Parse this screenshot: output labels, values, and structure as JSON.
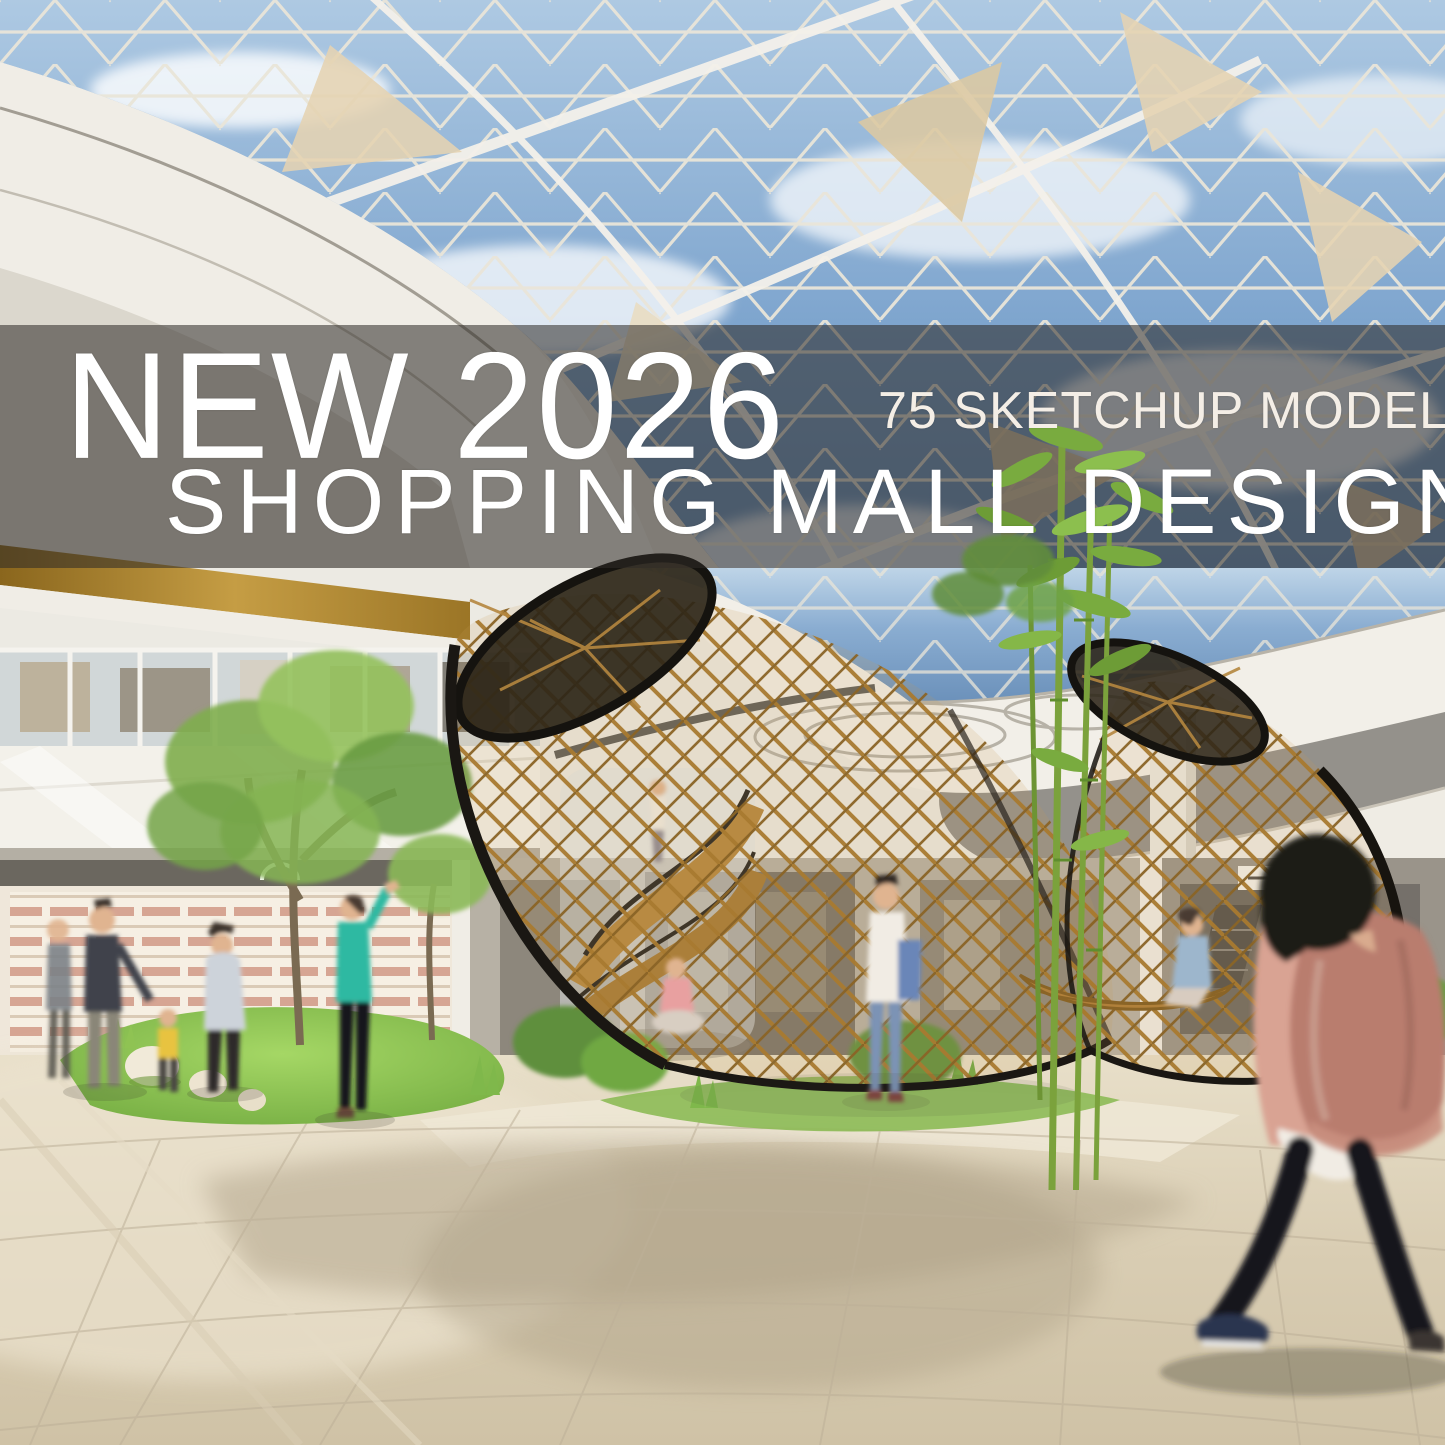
{
  "poster": {
    "title_line1": "NEW 2026",
    "badge": "75 SKETCHUP MODEL",
    "title_line2": "SHOPPING MALL DESIGN",
    "text_color": "#ffffff",
    "banner_overlay_color": "#2e2b28",
    "banner_overlay_opacity": "0.56"
  },
  "scene": {
    "elements": [
      "glass-dome-skylight",
      "blue-sky-with-clouds",
      "fabric-shade-sails",
      "curved-atrium-balconies",
      "gold-trim-band",
      "level2-shopfront-glass",
      "ground-floor-storefronts",
      "spiral-wood-staircase",
      "wood-lattice-pavilion-left",
      "wood-lattice-pavilion-right",
      "indoor-garden-islands",
      "bamboo-plants",
      "shoppers",
      "foreground-walking-woman",
      "stone-paved-floor"
    ],
    "palette": {
      "sky": "#6e97c4",
      "sky_light": "#b9d2e8",
      "glass_frame": "#e9e4d8",
      "ceiling_white": "#f2efe8",
      "gold_trim": "#a97f2a",
      "wood": "#b5833f",
      "lattice_rim": "#1a1713",
      "foliage": "#79a848",
      "grass": "#8fc353",
      "floor": "#d8cdb8",
      "floor_shadow": "#b0a287",
      "teal_shirt": "#2fb9a2",
      "denim": "#7c93b5",
      "bag": "#b97d6e",
      "skin": "#e0b490"
    }
  }
}
